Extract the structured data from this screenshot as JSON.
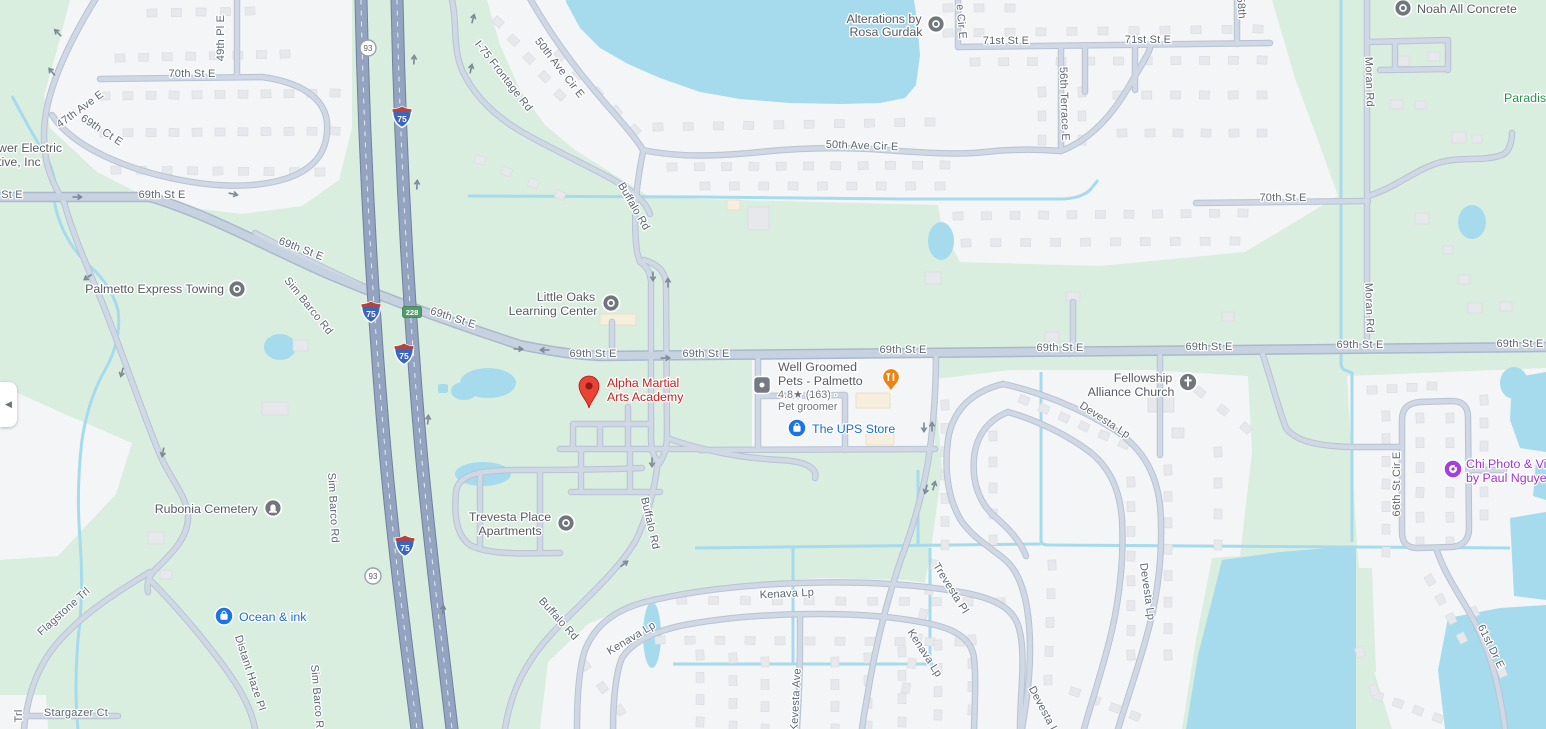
{
  "map": {
    "colors": {
      "green": "#d9eedf",
      "urban": "#f4f5f6",
      "water": "#a6dbee",
      "building": "#e7e8eb",
      "building_stroke": "#d9dbdf",
      "beige_building": "#f6efdd",
      "beige_stroke": "#e8ddc0",
      "road_minor": "#cfd8e4",
      "road_minor_casing": "#b7c3d3",
      "road_major": "#c7d2e0",
      "road_major_casing": "#a9b8cc",
      "highway": "#94a4c0",
      "highway_casing": "#71809d",
      "label": "#5c6671",
      "poi_text": "#565a60",
      "store_blue": "#1a6dd5",
      "selected_red": "#c5221f",
      "icon_gray": "#71767d",
      "food_orange": "#f0830f",
      "photo_purple": "#a33fe0",
      "park_green_text": "#2f8f4f",
      "interstate_blue": "#3b66bf",
      "interstate_red": "#b8433a",
      "exit_green": "#4f9d68"
    },
    "road_labels": [
      {
        "t": "70th St E",
        "x": 192,
        "y": 77
      },
      {
        "t": "49th Pl E",
        "x": 224,
        "y": 38,
        "r": -90
      },
      {
        "t": "47th Ave E",
        "x": 82,
        "y": 112,
        "r": -36
      },
      {
        "t": "69th Ct E",
        "x": 100,
        "y": 133,
        "r": 33
      },
      {
        "t": "St E",
        "x": 12,
        "y": 198
      },
      {
        "t": "69th St E",
        "x": 162,
        "y": 198
      },
      {
        "t": "69th St E",
        "x": 300,
        "y": 252,
        "r": 21
      },
      {
        "t": "69th St E",
        "x": 452,
        "y": 321,
        "r": 18
      },
      {
        "t": "69th St E",
        "x": 593,
        "y": 357
      },
      {
        "t": "69th St E",
        "x": 706,
        "y": 357
      },
      {
        "t": "69th St E",
        "x": 903,
        "y": 353
      },
      {
        "t": "69th St E",
        "x": 1060,
        "y": 351
      },
      {
        "t": "69th St E",
        "x": 1209,
        "y": 350
      },
      {
        "t": "69th St E",
        "x": 1360,
        "y": 348
      },
      {
        "t": "69th St E",
        "x": 1520,
        "y": 347
      },
      {
        "t": "Sim Barco Rd",
        "x": 306,
        "y": 308,
        "r": 51
      },
      {
        "t": "Sim Barco Rd",
        "x": 330,
        "y": 508,
        "r": 87
      },
      {
        "t": "Sim Barco Rd",
        "x": 314,
        "y": 700,
        "r": 85
      },
      {
        "t": "I-75 Frontage Rd",
        "x": 501,
        "y": 78,
        "r": 52
      },
      {
        "t": "50th Ave Cir E",
        "x": 557,
        "y": 70,
        "r": 52
      },
      {
        "t": "50th Ave Cir E",
        "x": 862,
        "y": 149,
        "r": 2
      },
      {
        "t": "Buffalo Rd",
        "x": 631,
        "y": 208,
        "r": 60
      },
      {
        "t": "Buffalo Rd",
        "x": 647,
        "y": 524,
        "r": 77
      },
      {
        "t": "Buffalo Rd",
        "x": 556,
        "y": 621,
        "r": 48
      },
      {
        "t": "e Cir E",
        "x": 958,
        "y": 22,
        "r": 85
      },
      {
        "t": "71st St E",
        "x": 1006,
        "y": 44
      },
      {
        "t": "71st St E",
        "x": 1148,
        "y": 43
      },
      {
        "t": "58th",
        "x": 1238,
        "y": 8,
        "r": 85
      },
      {
        "t": "56th Terrace E",
        "x": 1061,
        "y": 104,
        "r": 88
      },
      {
        "t": "70th St E",
        "x": 1283,
        "y": 201
      },
      {
        "t": "Moran Rd",
        "x": 1366,
        "y": 82,
        "r": 88
      },
      {
        "t": "Moran Rd",
        "x": 1366,
        "y": 308,
        "r": 88
      },
      {
        "t": "Flagstone Trl",
        "x": 66,
        "y": 614,
        "r": -42
      },
      {
        "t": "Distant Haze Pl",
        "x": 247,
        "y": 674,
        "r": 72
      },
      {
        "t": "Stargazer Ct",
        "x": 76,
        "y": 716
      },
      {
        "t": "Trl",
        "x": 22,
        "y": 716,
        "r": -90
      },
      {
        "t": "Kenava Lp",
        "x": 787,
        "y": 597,
        "r": -3
      },
      {
        "t": "Kenava Lp",
        "x": 633,
        "y": 641,
        "r": -31
      },
      {
        "t": "Kenava Lp",
        "x": 922,
        "y": 655,
        "r": 57
      },
      {
        "t": "Kevesta Ave",
        "x": 799,
        "y": 700,
        "r": -87
      },
      {
        "t": "Trevesta Pl",
        "x": 948,
        "y": 590,
        "r": 58
      },
      {
        "t": "Devesta Lp",
        "x": 1103,
        "y": 423,
        "r": 33
      },
      {
        "t": "Devesta Lp",
        "x": 1144,
        "y": 592,
        "r": 82
      },
      {
        "t": "Devesta Lp",
        "x": 1042,
        "y": 714,
        "r": 62
      },
      {
        "t": "66th St Cir E",
        "x": 1400,
        "y": 484,
        "r": -90
      },
      {
        "t": "61st Dr E",
        "x": 1488,
        "y": 648,
        "r": 64
      }
    ],
    "pois": [
      {
        "id": "alterations-by-rosa-gurdak",
        "icon": "circle-dot",
        "ix": 936,
        "iy": 24,
        "lines": [
          {
            "t": "Alterations by",
            "x": 884,
            "y": 23,
            "a": "middle"
          },
          {
            "t": "Rosa Gurdak",
            "x": 886,
            "y": 36,
            "a": "middle"
          }
        ]
      },
      {
        "id": "noah-all-concrete",
        "icon": "circle-dot",
        "ix": 1403,
        "iy": 8,
        "lines": [
          {
            "t": "Noah All Concrete",
            "x": 1417,
            "y": 13,
            "a": "start"
          }
        ]
      },
      {
        "id": "palmetto-express-towing",
        "icon": "circle-dot",
        "ix": 237,
        "iy": 289,
        "lines": [
          {
            "t": "Palmetto Express Towing",
            "x": 224,
            "y": 293,
            "a": "end"
          }
        ]
      },
      {
        "id": "little-oaks-learning-center",
        "icon": "circle-dot",
        "ix": 611,
        "iy": 303,
        "lines": [
          {
            "t": "Little Oaks",
            "x": 566,
            "y": 301,
            "a": "middle"
          },
          {
            "t": "Learning Center",
            "x": 553,
            "y": 315,
            "a": "middle"
          }
        ]
      },
      {
        "id": "alpha-martial-arts-academy",
        "icon": "pin",
        "ix": 589,
        "iy": 388,
        "cls": "red",
        "lines": [
          {
            "t": "Alpha Martial",
            "x": 607,
            "y": 387,
            "a": "start"
          },
          {
            "t": "Arts Academy",
            "x": 607,
            "y": 401,
            "a": "start"
          }
        ]
      },
      {
        "id": "well-groomed-pets-palmetto",
        "icon": "square-dot",
        "ix": 762,
        "iy": 385,
        "lines": [
          {
            "t": "Well Groomed",
            "x": 778,
            "y": 371,
            "a": "start"
          },
          {
            "t": "Pets - Palmetto",
            "x": 778,
            "y": 385,
            "a": "start"
          },
          {
            "t": "4.8★ (163) ·",
            "x": 778,
            "y": 398,
            "a": "start",
            "cls": "sub"
          },
          {
            "t": "Pet groomer",
            "x": 778,
            "y": 410,
            "a": "start",
            "cls": "sub"
          }
        ]
      },
      {
        "id": "restaurant-marker",
        "icon": "food-pin",
        "ix": 891,
        "iy": 378,
        "lines": []
      },
      {
        "id": "the-ups-store",
        "icon": "bag",
        "ix": 797,
        "iy": 428,
        "cls": "blue",
        "lines": [
          {
            "t": "The UPS Store",
            "x": 812,
            "y": 433,
            "a": "start"
          }
        ]
      },
      {
        "id": "fellowship-alliance-church",
        "icon": "church",
        "ix": 1188,
        "iy": 382,
        "lines": [
          {
            "t": "Fellowship",
            "x": 1143,
            "y": 382,
            "a": "middle"
          },
          {
            "t": "Alliance Church",
            "x": 1131,
            "y": 396,
            "a": "middle"
          }
        ]
      },
      {
        "id": "chi-photo-by-paul-nguyen",
        "icon": "camera",
        "ix": 1453,
        "iy": 469,
        "cls": "purple",
        "lines": [
          {
            "t": "Chi Photo & Vi",
            "x": 1466,
            "y": 468,
            "a": "start"
          },
          {
            "t": "by Paul Nguye",
            "x": 1466,
            "y": 482,
            "a": "start"
          }
        ]
      },
      {
        "id": "rubonia-cemetery",
        "icon": "cemetery",
        "ix": 273,
        "iy": 508,
        "lines": [
          {
            "t": "Rubonia Cemetery",
            "x": 258,
            "y": 513,
            "a": "end"
          }
        ]
      },
      {
        "id": "ocean-and-ink",
        "icon": "bag",
        "ix": 224,
        "iy": 616,
        "cls": "blue",
        "lines": [
          {
            "t": "Ocean & ink",
            "x": 239,
            "y": 621,
            "a": "start"
          }
        ]
      },
      {
        "id": "trevesta-place-apartments",
        "icon": "circle-dot",
        "ix": 566,
        "iy": 523,
        "lines": [
          {
            "t": "Trevesta Place",
            "x": 510,
            "y": 521,
            "a": "middle"
          },
          {
            "t": "Apartments",
            "x": 510,
            "y": 535,
            "a": "middle"
          }
        ]
      },
      {
        "id": "paradise-park-label",
        "icon": "none",
        "cls": "green",
        "lines": [
          {
            "t": "Paradise",
            "x": 1504,
            "y": 102,
            "a": "start"
          }
        ]
      },
      {
        "id": "electric-cooperative-label",
        "icon": "none",
        "lines": [
          {
            "t": "wer Electric",
            "x": -2,
            "y": 152,
            "a": "start"
          },
          {
            "t": "tive, Inc",
            "x": -2,
            "y": 166,
            "a": "start"
          }
        ]
      }
    ],
    "shields": [
      {
        "type": "interstate",
        "t": "75",
        "x": 402,
        "y": 117
      },
      {
        "type": "interstate",
        "t": "75",
        "x": 371,
        "y": 312
      },
      {
        "type": "interstate",
        "t": "75",
        "x": 404,
        "y": 354
      },
      {
        "type": "interstate",
        "t": "75",
        "x": 405,
        "y": 546
      },
      {
        "type": "circle",
        "t": "93",
        "x": 368,
        "y": 48
      },
      {
        "type": "circle",
        "t": "93",
        "x": 373,
        "y": 576
      }
    ],
    "exit_badge": {
      "t": "228",
      "x": 412,
      "y": 312
    },
    "ui": {
      "collapse_glyph": "◀"
    }
  }
}
